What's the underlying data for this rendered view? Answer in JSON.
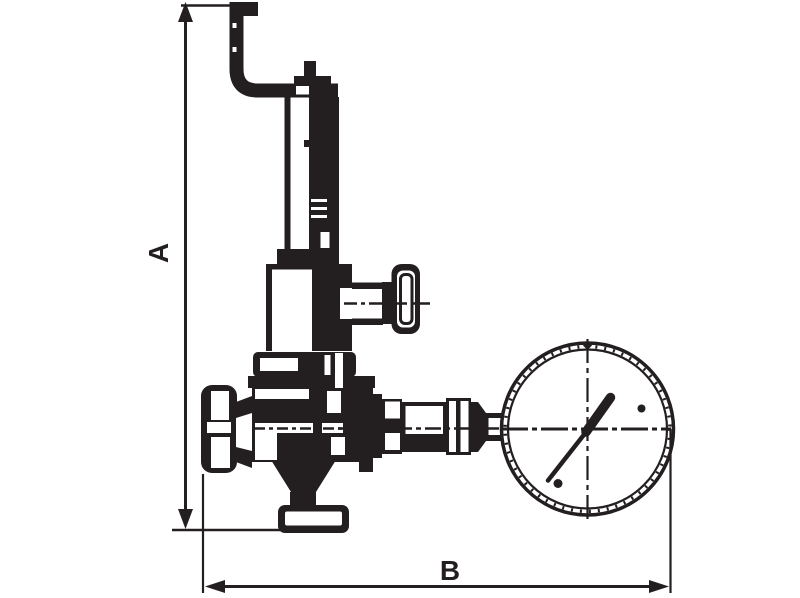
{
  "labels": {
    "dimension_a": "A",
    "dimension_b": "B"
  },
  "colors": {
    "line": "#231f20",
    "background": "#ffffff"
  }
}
